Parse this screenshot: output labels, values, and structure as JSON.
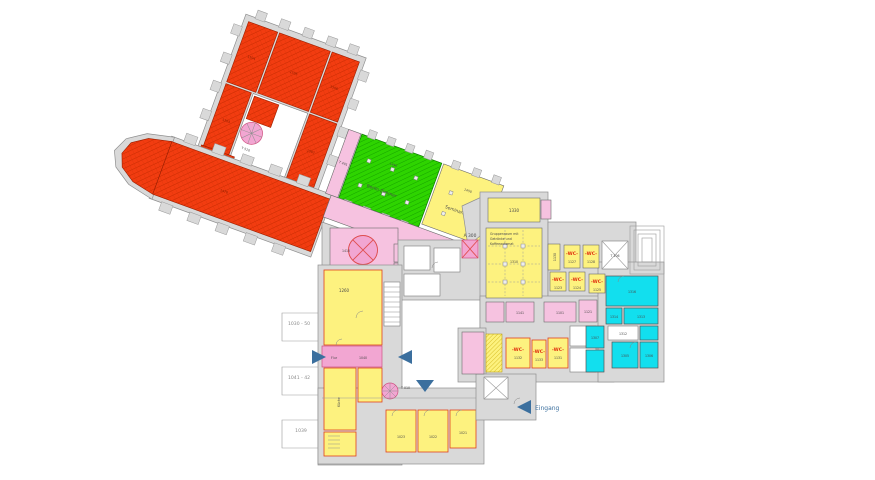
{
  "colors": {
    "demolition_red": "#f23c10",
    "hatch_red": "#c32a00",
    "hall_green": "#2ed400",
    "room_yellow": "#fdf27f",
    "corridor_pink": "#f6c2e0",
    "strong_pink": "#f2a6d2",
    "room_cyan": "#12dfee",
    "wall_gray": "#d9d9d9",
    "outline_red": "#e0401c",
    "arrow_blue": "#3b6f9e",
    "wc_text_red": "#e03010"
  },
  "halls": {
    "green_no": "1440",
    "green_name": "Berlin Zimmer",
    "seminar_no": "1450",
    "seminar_name": "Seminarraum",
    "nave_no": "1470",
    "corridor_no": "1430"
  },
  "gruppenraum": {
    "l1": "Gruppenraum mit",
    "l2": "Getränke und",
    "l3": "Kaffeeautomat",
    "no": "1310"
  },
  "stairs": {
    "t510": "T 510",
    "t010": "T 010",
    "t106": "T 106",
    "t401": "T 401",
    "a300": "A 300"
  },
  "junction": {
    "no": "1410",
    "pink1": "1405"
  },
  "left_wing": {
    "room": "1260",
    "flur": "Flur",
    "flur_no": "1040",
    "kueche": "Küche"
  },
  "bottom_rooms": [
    "1023",
    "1022",
    "1021"
  ],
  "right_block": {
    "room1330": "1330",
    "room1130": "1130"
  },
  "wc": {
    "label": "-WC-",
    "top": [
      "1127",
      "1128"
    ],
    "mid": [
      "1123",
      "1124",
      "1125"
    ],
    "low": [
      "1132",
      "1133",
      "1131"
    ]
  },
  "pink_rooms": [
    "1141",
    "1101",
    "1121"
  ],
  "cyan_rooms": {
    "r1316": "1316",
    "r1314": "1314",
    "r1313": "1313",
    "r1312": "1312",
    "r1305": "1305",
    "r1306": "1306",
    "r1307": "1307"
  },
  "red_rooms": [
    "1503",
    "1504",
    "1505",
    "1506",
    "1507"
  ],
  "dimensions": [
    "1030 - 50",
    "1041 - 42",
    "1039"
  ],
  "entrance": "Eingang"
}
